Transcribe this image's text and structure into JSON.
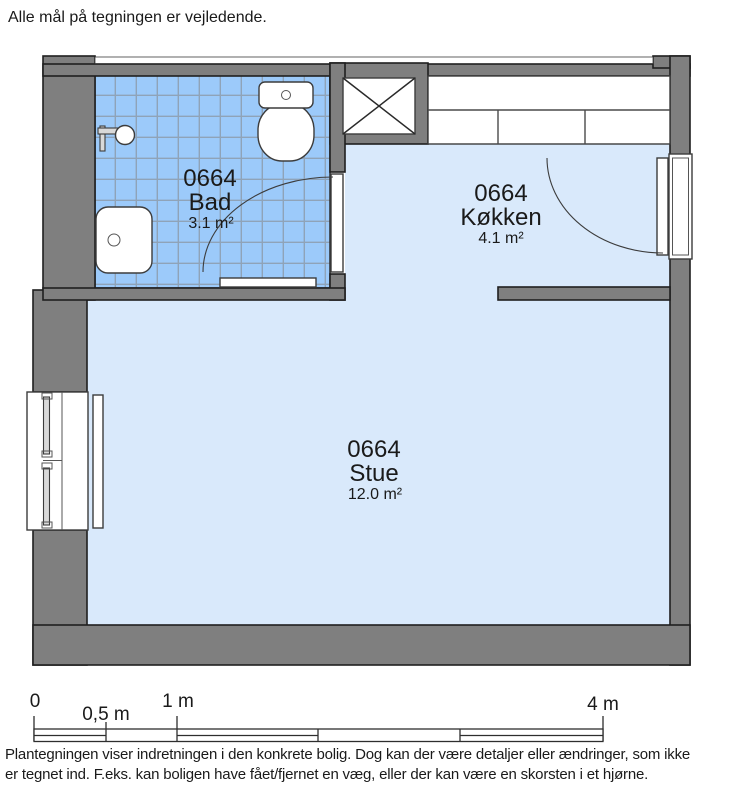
{
  "colors": {
    "wall": "#7f7f7f",
    "outline": "#1f1f1f",
    "tile": "#9ccafa",
    "tileGrid": "#8fa3b8",
    "floor": "#d9e9fb",
    "fixture": "#ffffff",
    "text": "#1a1a1a"
  },
  "note": "Alle mål på tegningen er vejledende.",
  "rooms": [
    {
      "number": "0664",
      "name": "Bad",
      "area": "3.1 m²"
    },
    {
      "number": "0664",
      "name": "Køkken",
      "area": "4.1 m²"
    },
    {
      "number": "0664",
      "name": "Stue",
      "area": "12.0 m²"
    }
  ],
  "symbols": {
    "toilet": "toilet with cistern",
    "sink": "hand basin",
    "shower": "shower fitting",
    "radiator": "radiator bar",
    "vent_shaft": "crossed ventilation/installation shaft",
    "kitchen_counter": "kitchen worktop with cabinets",
    "window": "double window in outer wall",
    "door_swing": "door leaf with quarter-circle swing arc"
  },
  "scale_bar": {
    "labels": [
      "0",
      "0,5 m",
      "1 m",
      "4 m"
    ]
  },
  "disclaimer": [
    "Plantegningen viser indretningen i den konkrete bolig. Dog kan der være detaljer eller ændringer, som ikke",
    "er tegnet ind. F.eks. kan boligen have fået/fjernet en væg, eller der kan være en skorsten i et hjørne."
  ]
}
